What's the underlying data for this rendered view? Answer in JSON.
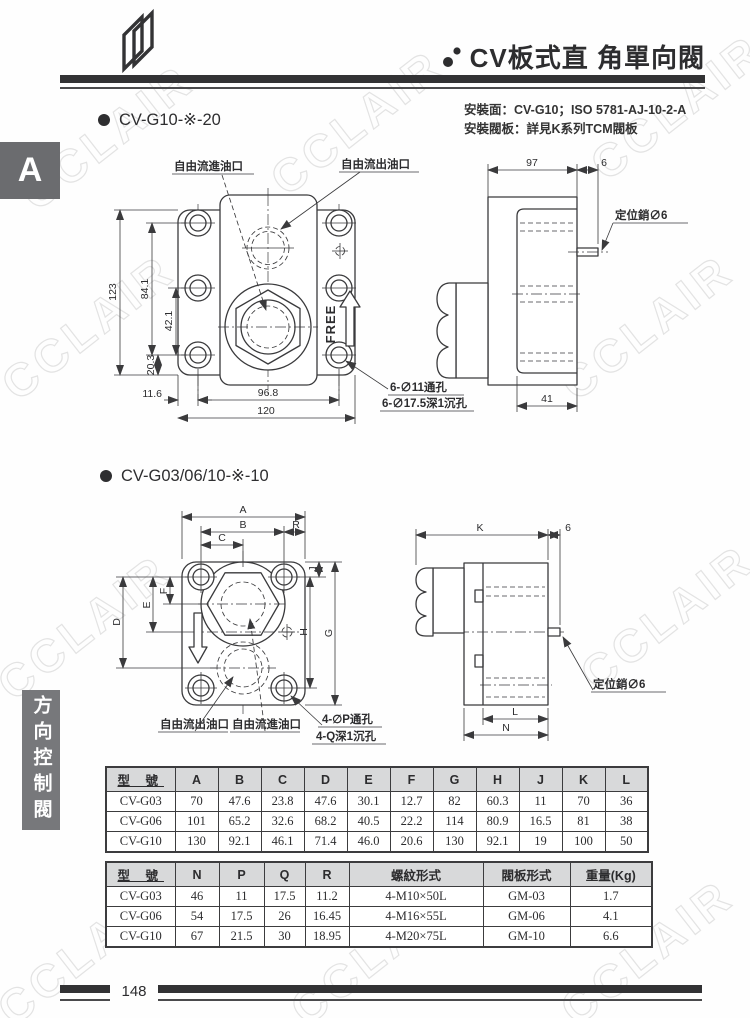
{
  "page": {
    "number": "148",
    "watermark": "CCLAIR"
  },
  "sidebar": {
    "tab_letter": "A",
    "category": "方向控制閥"
  },
  "header": {
    "title": "CV板式直 角單向閥",
    "mounting_line1": "安裝面：CV-G10；ISO 5781-AJ-10-2-A",
    "mounting_line2": "安裝閥板：詳見K系列TCM閥板"
  },
  "section1": {
    "heading": "CV-G10-※-20",
    "front": {
      "labels": {
        "inlet": "自由流進油口",
        "outlet": "自由流出油口",
        "flow": "FREE",
        "note1": "6-∅11通孔",
        "note2": "6-∅17.5深1沉孔"
      },
      "dims": {
        "h_total": "123",
        "h_holes": "84.1",
        "h_mid": "42.1",
        "h_bottom": "20.3",
        "w_offset": "11.6",
        "w_holes": "96.8",
        "w_total": "120"
      }
    },
    "side": {
      "dims": {
        "depth": "97",
        "pin_len": "6",
        "port_depth": "41"
      },
      "pin_label": "定位銷∅6"
    }
  },
  "section2": {
    "heading": "CV-G03/06/10-※-10",
    "front": {
      "labels": {
        "outlet": "自由流出油口",
        "inlet": "自由流進油口",
        "note1": "4-∅P通孔",
        "note2": "4-Q深1沉孔"
      },
      "dims": {
        "A": "A",
        "B": "B",
        "C": "C",
        "D": "D",
        "E": "E",
        "F": "F",
        "G": "G",
        "H": "H",
        "J": "J",
        "R": "R"
      }
    },
    "side": {
      "dims": {
        "K": "K",
        "pin_len": "6",
        "L": "L",
        "N": "N"
      },
      "pin_label": "定位銷∅6"
    }
  },
  "table1": {
    "headers": [
      "型 號",
      "A",
      "B",
      "C",
      "D",
      "E",
      "F",
      "G",
      "H",
      "J",
      "K",
      "L"
    ],
    "rows": [
      [
        "CV-G03",
        "70",
        "47.6",
        "23.8",
        "47.6",
        "30.1",
        "12.7",
        "82",
        "60.3",
        "11",
        "70",
        "36"
      ],
      [
        "CV-G06",
        "101",
        "65.2",
        "32.6",
        "68.2",
        "40.5",
        "22.2",
        "114",
        "80.9",
        "16.5",
        "81",
        "38"
      ],
      [
        "CV-G10",
        "130",
        "92.1",
        "46.1",
        "71.4",
        "46.0",
        "20.6",
        "130",
        "92.1",
        "19",
        "100",
        "50"
      ]
    ]
  },
  "table2": {
    "headers": [
      "型 號",
      "N",
      "P",
      "Q",
      "R",
      "螺紋形式",
      "閥板形式",
      "重量(Kg)"
    ],
    "rows": [
      [
        "CV-G03",
        "46",
        "11",
        "17.5",
        "11.2",
        "4-M10×50L",
        "GM-03",
        "1.7"
      ],
      [
        "CV-G06",
        "54",
        "17.5",
        "26",
        "16.45",
        "4-M16×55L",
        "GM-06",
        "4.1"
      ],
      [
        "CV-G10",
        "67",
        "21.5",
        "30",
        "18.95",
        "4-M20×75L",
        "GM-10",
        "6.6"
      ]
    ]
  }
}
